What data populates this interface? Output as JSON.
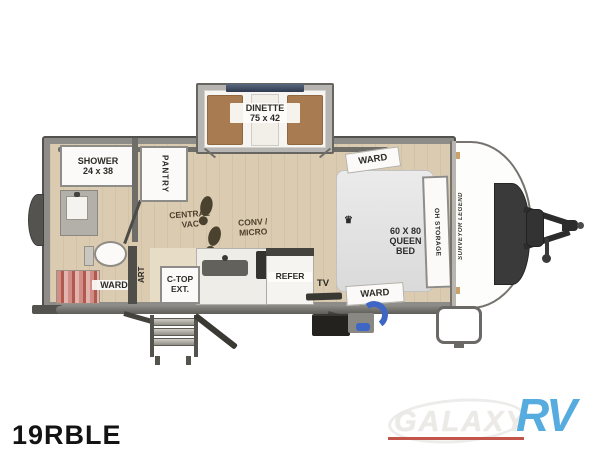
{
  "model": "19RBLE",
  "floorplan": {
    "dinette": "DINETTE\n75 x 42",
    "shower": "SHOWER\n24 x 38",
    "pantry": "PANTRY",
    "central_vac": "CENTRAL\nVAC",
    "conv_micro": "CONV /\nMICRO",
    "ctop_ext": "C-TOP\nEXT.",
    "art": "ART",
    "ward_bath": "WARD",
    "ward_front_top": "WARD",
    "ward_front_bottom": "WARD",
    "oh_storage": "OH STORAGE",
    "bed_crown_icon": "♛",
    "queen_bed": "60 X 80\nQUEEN BED",
    "refer": "REFER",
    "tv": "TV",
    "brand": "SURVEYOR LEGEND"
  },
  "logo": {
    "word1": "GALAXY",
    "word2": "RV"
  },
  "colors": {
    "floor": "#dbcbb1",
    "wall": "#8e8c88",
    "bench_wood": "#a87c50",
    "bed_gray": "#e3e3e3",
    "rock_guard": "#3a3a3a",
    "hose_blue": "#3f66c4",
    "logo_blue": "#56abdf",
    "logo_red": "#c2544a"
  }
}
